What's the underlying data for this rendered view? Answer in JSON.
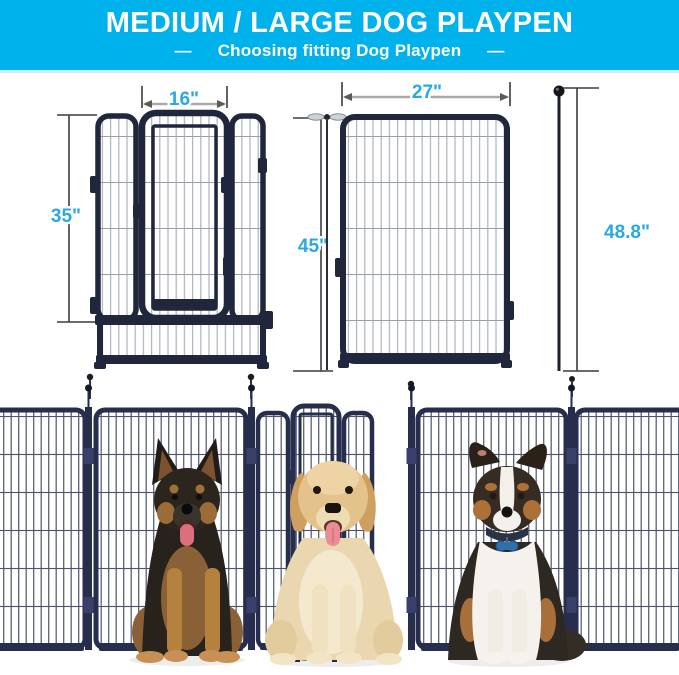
{
  "header": {
    "title": "MEDIUM / LARGE DOG PLAYPEN",
    "dash_left": "—",
    "subtitle": "Choosing fitting Dog Playpen",
    "dash_right": "—",
    "bg_color": "#00b2ec",
    "text_color": "#ffffff"
  },
  "diagrams": {
    "accent_color": "#2aa9de",
    "frame_color": "#20263c",
    "door_panel_diagram": {
      "door_width_label": "16\"",
      "height_label": "35\""
    },
    "large_panel_diagram": {
      "width_label": "27\"",
      "height_label": "45\""
    },
    "ground_stake": {
      "length_label": "48.8\""
    }
  },
  "photo": {
    "fence": "connected-playpen-panels",
    "dogs": [
      {
        "name": "german-shepherd"
      },
      {
        "name": "golden-retriever"
      },
      {
        "name": "australian-shepherd"
      }
    ],
    "photo_frame_color": "#272e4d"
  }
}
